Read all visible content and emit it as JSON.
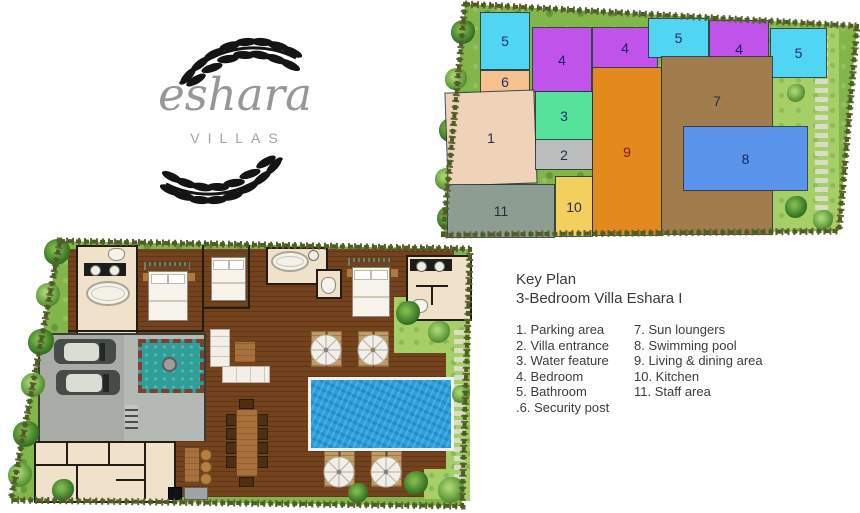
{
  "logo": {
    "brand": "eshara",
    "subtitle": "VILLAS"
  },
  "key_plan": {
    "zones": [
      {
        "label": "5",
        "area": "bathroom",
        "color": "#50d6f2",
        "text_color": "#1c2f6e"
      },
      {
        "label": "6",
        "area": "security-post",
        "color": "#f6c18d",
        "text_color": "#1c2f6e"
      },
      {
        "label": "4",
        "area": "bedroom",
        "color": "#bf53ea",
        "text_color": "#20195e"
      },
      {
        "label": "4",
        "area": "bedroom",
        "color": "#bf53ea",
        "text_color": "#20195e"
      },
      {
        "label": "5",
        "area": "bathroom",
        "color": "#50d6f2",
        "text_color": "#1c2f6e"
      },
      {
        "label": "4",
        "area": "bedroom",
        "color": "#bf53ea",
        "text_color": "#20195e"
      },
      {
        "label": "5",
        "area": "bathroom",
        "color": "#50d6f2",
        "text_color": "#1c2f6e"
      },
      {
        "label": "1",
        "area": "parking-area",
        "color": "#eed3b9",
        "text_color": "#273046"
      },
      {
        "label": "3",
        "area": "water-feature",
        "color": "#57e29b",
        "text_color": "#1c2f6e"
      },
      {
        "label": "2",
        "area": "villa-entrance",
        "color": "#b9bdbb",
        "text_color": "#273046"
      },
      {
        "label": "9",
        "area": "living-dining-area",
        "color": "#e3891d",
        "text_color": "#7c1d0e"
      },
      {
        "label": "7",
        "area": "sun-loungers",
        "color": "#a17d4e",
        "text_color": "#232d38"
      },
      {
        "label": "8",
        "area": "swimming-pool",
        "color": "#5b95eb",
        "text_color": "#15265c"
      },
      {
        "label": "11",
        "area": "staff-area",
        "color": "#8e9d91",
        "text_color": "#232d38"
      },
      {
        "label": "10",
        "area": "kitchen",
        "color": "#f3cf5e",
        "text_color": "#273046"
      }
    ]
  },
  "legend": {
    "title": "Key Plan",
    "subtitle": "3-Bedroom Villa Eshara I",
    "column1": [
      "1. Parking area",
      "2. Villa entrance",
      "3. Water feature",
      "4. Bedroom",
      "5. Bathroom",
      ".6. Security post"
    ],
    "column2": [
      "7. Sun loungers",
      "8. Swimming pool",
      "9. Living & dining area",
      "10. Kitchen",
      "11. Staff area"
    ]
  },
  "colors": {
    "garden_green": "#82b54a",
    "lawn_light": "#a6cf68",
    "deck_wood": "#74431d",
    "room_cream": "#f0e2ca",
    "pool_blue": "#2aa0dc",
    "water_feature_teal": "#2f9d98",
    "parking_gray": "#a8aba6"
  }
}
